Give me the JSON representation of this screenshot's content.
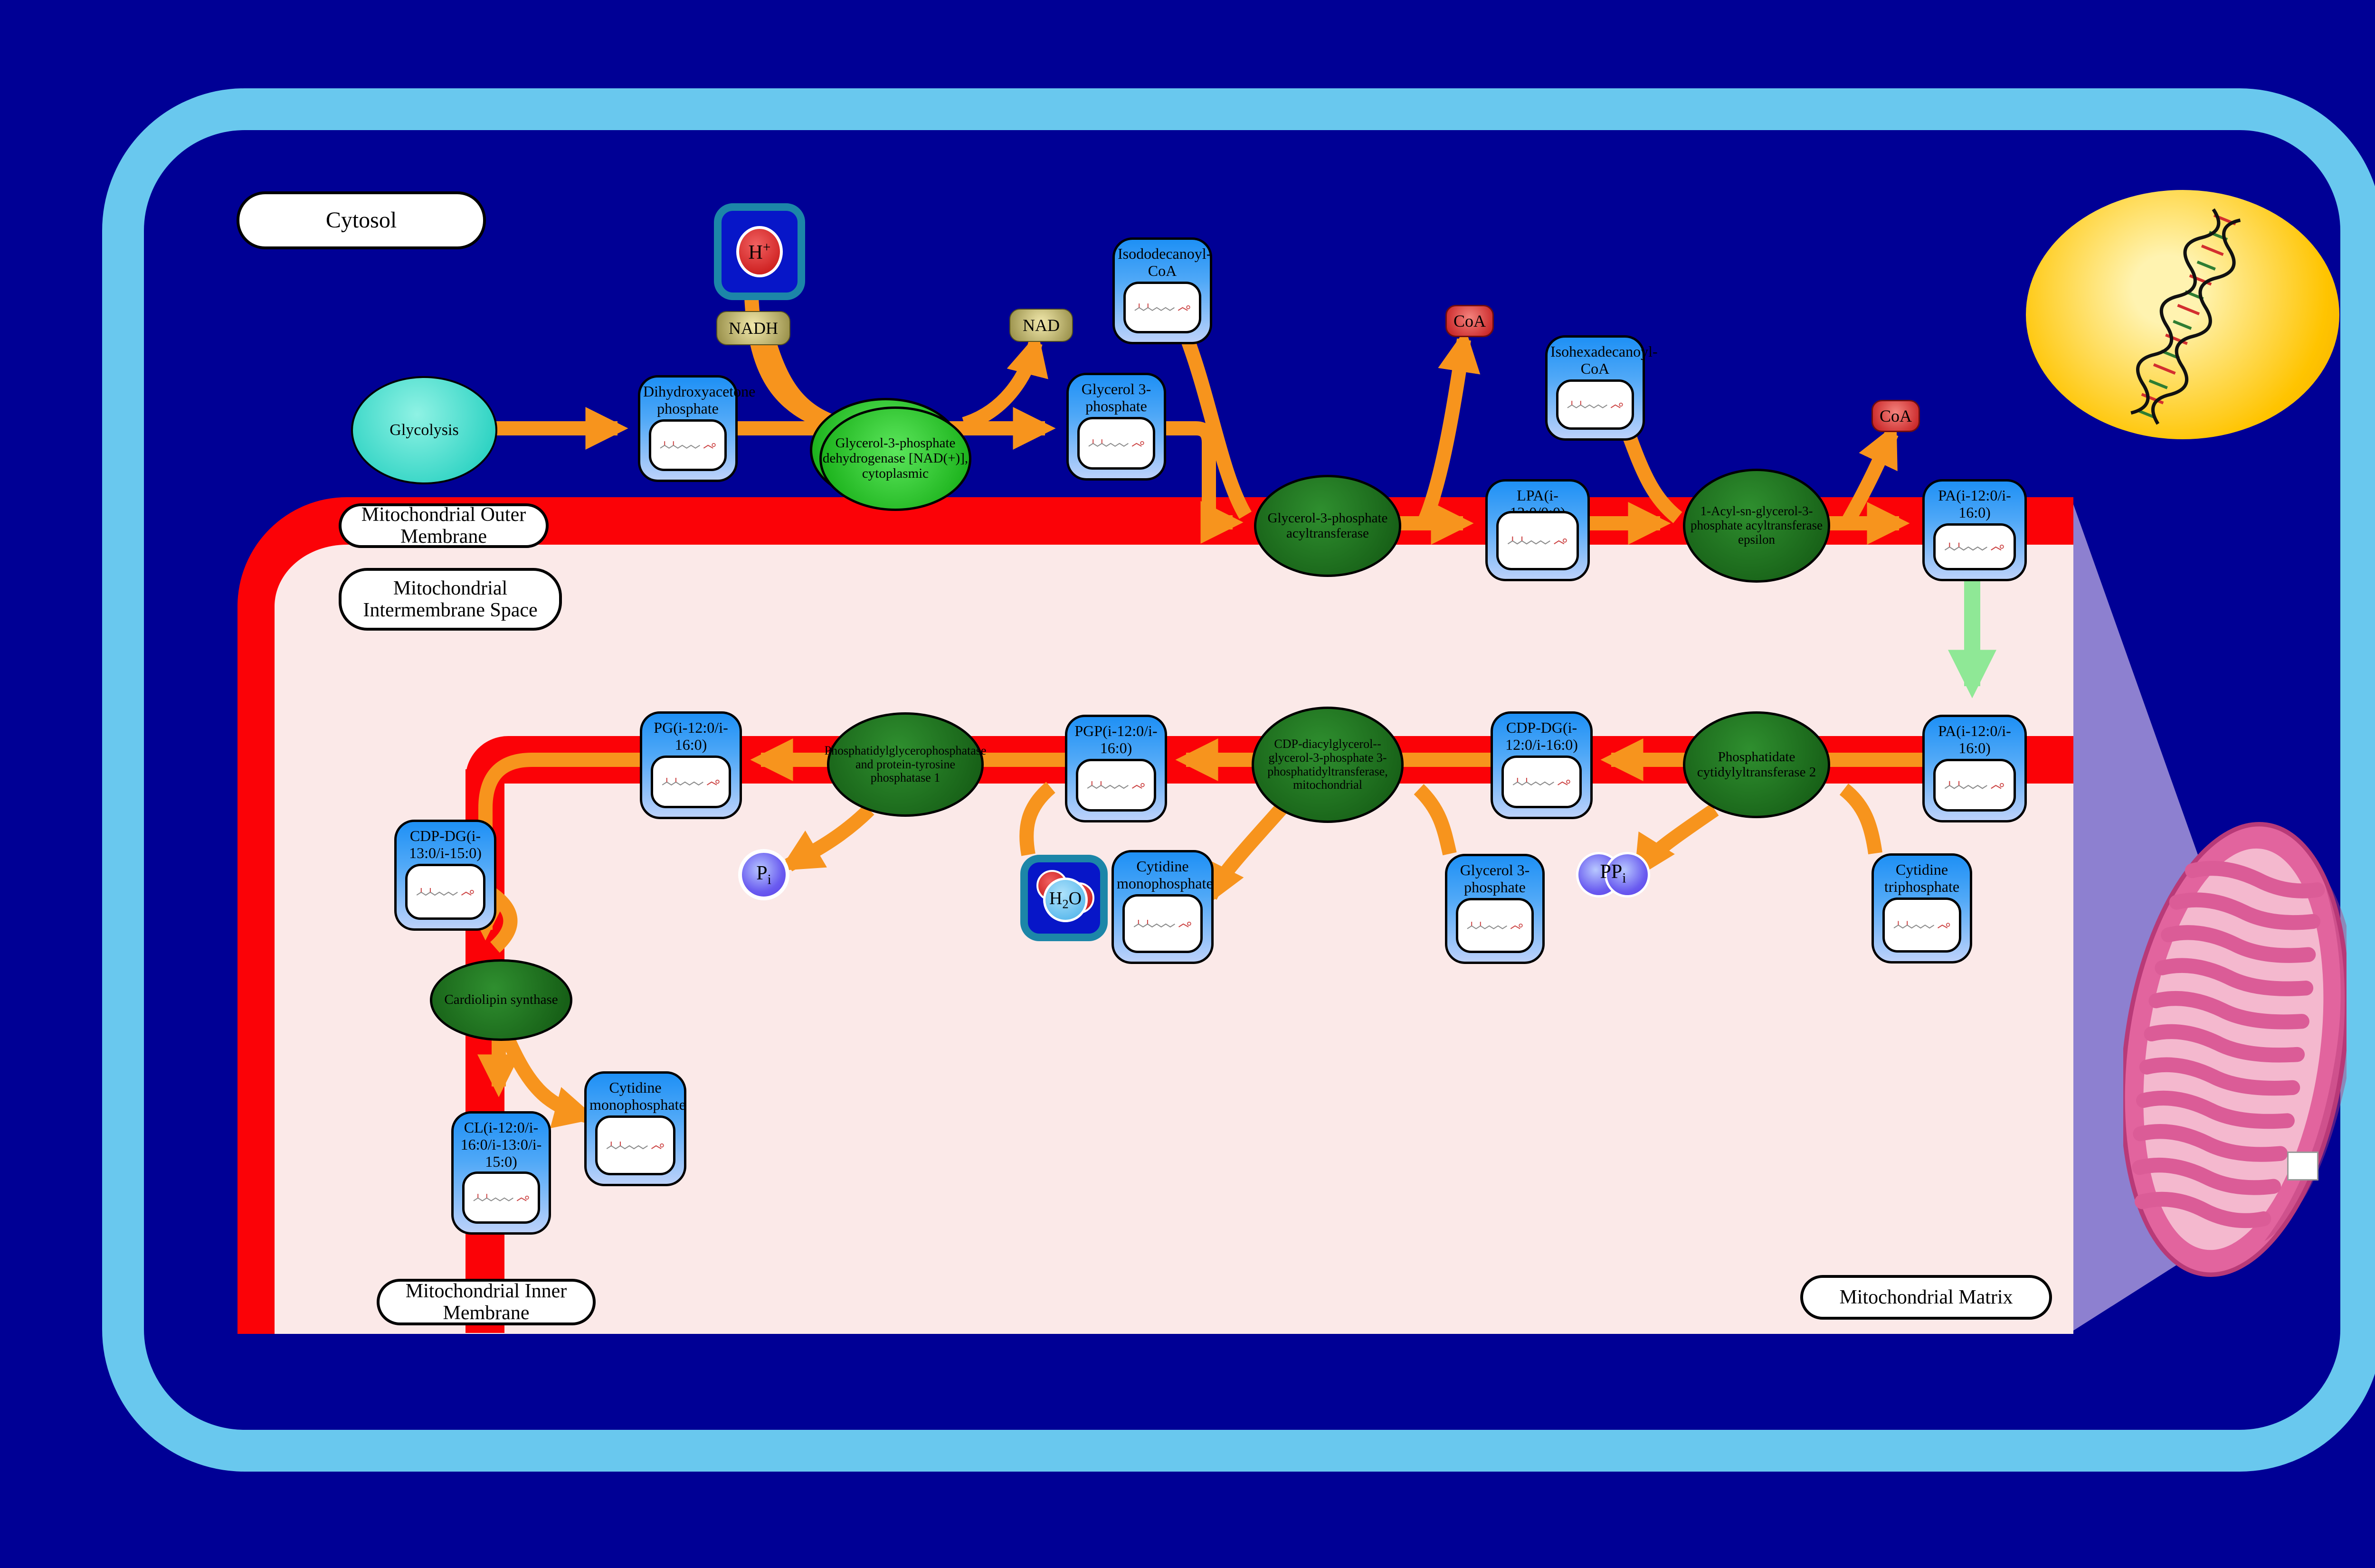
{
  "compartments": {
    "cytosol": "Cytosol",
    "outer_membrane": "Mitochondrial Outer Membrane",
    "intermembrane_space": "Mitochondrial Intermembrane Space",
    "inner_membrane": "Mitochondrial Inner Membrane",
    "matrix": "Mitochondrial Matrix"
  },
  "nodes": {
    "glycolysis": {
      "label": "Glycolysis"
    },
    "dhap": {
      "label": "Dihydroxyacetone phosphate"
    },
    "gpd1": {
      "label": "Glycerol-3-phosphate dehydrogenase [NAD(+)], cytoplasmic"
    },
    "nadh": {
      "label": "NADH"
    },
    "nad": {
      "label": "NAD"
    },
    "hplus": {
      "base": "H",
      "sup": "+"
    },
    "g3p_top": {
      "label": "Glycerol 3-phosphate"
    },
    "isododecanoyl": {
      "label": "Isododecanoyl-CoA"
    },
    "gpat": {
      "label": "Glycerol-3-phosphate acyltransferase"
    },
    "coa1": {
      "label": "CoA"
    },
    "lpa": {
      "label": "LPA(i-12:0/0:0)"
    },
    "isohexadecanoyl": {
      "label": "Isohexadecanoyl-CoA"
    },
    "agpat_e": {
      "label": "1-Acyl-sn-glycerol-3-phosphate acyltransferase epsilon"
    },
    "coa2": {
      "label": "CoA"
    },
    "pa_outer": {
      "label": "PA(i-12:0/i-16:0)"
    },
    "pa_inner": {
      "label": "PA(i-12:0/i-16:0)"
    },
    "cds2": {
      "label": "Phosphatidate cytidylyltransferase 2"
    },
    "cdpdg1": {
      "label": "CDP-DG(i-12:0/i-16:0)"
    },
    "pgs1": {
      "label": "CDP-diacylglycerol--glycerol-3-phosphate 3-phosphatidyltransferase, mitochondrial"
    },
    "pgp": {
      "label": "PGP(i-12:0/i-16:0)"
    },
    "ptpmt1": {
      "label": "Phosphatidylglycerophosphatase and protein-tyrosine phosphatase 1"
    },
    "pg": {
      "label": "PG(i-12:0/i-16:0)"
    },
    "cdpdg2": {
      "label": "CDP-DG(i-13:0/i-15:0)"
    },
    "crls1": {
      "label": "Cardiolipin synthase"
    },
    "cl": {
      "label": "CL(i-12:0/i-16:0/i-13:0/i-15:0)"
    },
    "cmp1": {
      "label": "Cytidine monophosphate"
    },
    "cmp2": {
      "label": "Cytidine monophosphate"
    },
    "g3p_bottom": {
      "label": "Glycerol 3-phosphate"
    },
    "ctp": {
      "label": "Cytidine triphosphate"
    },
    "pi": {
      "base": "P",
      "sub": "i"
    },
    "ppi": {
      "base": "PP",
      "sub": "i"
    },
    "h2o": {
      "base": "H",
      "sub": "2",
      "tail": "O"
    }
  },
  "colors": {
    "background": "#000095",
    "cell_frame": "#69C8EE",
    "membrane_red": "#FB0207",
    "interior_pink": "#FBE9E8",
    "metabolite_blue": "#1E90F5",
    "enzyme_green": "#1E7E1E",
    "enzyme_green_bright": "#2FCC2F",
    "flux_arrow_orange": "#F7941D",
    "transport_arrow_green": "#90EE90",
    "nadh_khaki": "#C8BE78",
    "coa_red": "#D9302C",
    "ion_purple": "#6A5CF0",
    "nucleus_yellow": "#FFC400",
    "mitochondrion_pink": "#E2649E"
  }
}
